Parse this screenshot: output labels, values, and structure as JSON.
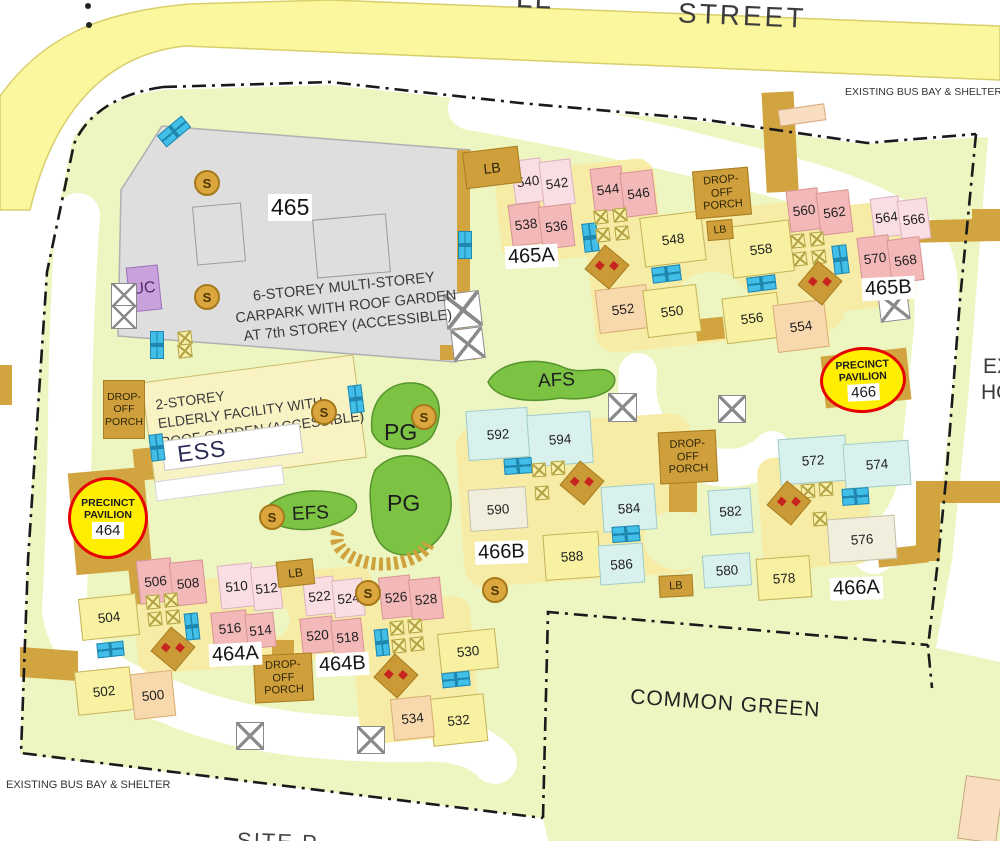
{
  "street": {
    "name": "STREET",
    "fragment": "LL"
  },
  "notes": {
    "bus_bay": "EXISTING BUS BAY & SHELTER",
    "common_green": "COMMON GREEN",
    "site_plan_fragment": "SITE P",
    "existing_right_line1": "EX",
    "existing_right_line2": "HO"
  },
  "carpark": {
    "number": "465",
    "line1": "6-STOREY MULTI-STOREY",
    "line2": "CARPARK WITH ROOF GARDEN",
    "line3": "AT 7th STOREY (ACCESSIBLE)",
    "uc": "UC"
  },
  "facility": {
    "line1": "2-STOREY",
    "line2": "ELDERLY FACILITY WITH",
    "line3": "ROOF GARDEN (ACCESSIBLE)",
    "ess": "ESS"
  },
  "areas": {
    "pg": "PG",
    "afs": "AFS",
    "efs": "EFS"
  },
  "clusters": {
    "c465": "465",
    "c465a": "465A",
    "c465b": "465B",
    "c466a": "466A",
    "c466b": "466B",
    "c464a": "464A",
    "c464b": "464B"
  },
  "pavilions": {
    "p464": {
      "line1": "PRECINCT",
      "line2": "PAVILION",
      "number": "464"
    },
    "p466": {
      "line1": "PRECINCT",
      "line2": "PAVILION",
      "number": "466"
    }
  },
  "porch": {
    "l1": "DROP-OFF",
    "l2": "PORCH",
    "s1": "DROP-",
    "s2": "OFF",
    "s3": "PORCH"
  },
  "lb_label": "LB",
  "s_label": "S",
  "units": {
    "u500": "500",
    "u502": "502",
    "u504": "504",
    "u506": "506",
    "u508": "508",
    "u510": "510",
    "u512": "512",
    "u514": "514",
    "u516": "516",
    "u518": "518",
    "u520": "520",
    "u522": "522",
    "u524": "524",
    "u526": "526",
    "u528": "528",
    "u530": "530",
    "u532": "532",
    "u534": "534",
    "u536": "536",
    "u538": "538",
    "u540": "540",
    "u542": "542",
    "u544": "544",
    "u546": "546",
    "u548": "548",
    "u550": "550",
    "u552": "552",
    "u554": "554",
    "u556": "556",
    "u558": "558",
    "u560": "560",
    "u562": "562",
    "u564": "564",
    "u566": "566",
    "u568": "568",
    "u570": "570",
    "u572": "572",
    "u574": "574",
    "u576": "576",
    "u578": "578",
    "u580": "580",
    "u582": "582",
    "u584": "584",
    "u586": "586",
    "u588": "588",
    "u590": "590",
    "u592": "592",
    "u594": "594"
  },
  "colors": {
    "site_green": "#edf5c1",
    "road_yellow": "#fbf79e",
    "path_tan": "#d2a440",
    "carpark_gray": "#dedede",
    "block_yellow": "#f8f1a2",
    "block_pink": "#f3b9b9",
    "block_light_pink": "#f9dee3",
    "block_peach": "#f8d9ae",
    "block_pale_cyan": "#d9f1ed",
    "block_cream": "#f1eedd",
    "lift_cyan": "#41bfe8",
    "s_gold": "#dca63e",
    "uc_purple": "#c9a2dd",
    "green_area": "#7cc243",
    "pavilion_yellow": "#ffee00",
    "pavilion_ring_red": "#e60000",
    "boundary_black": "#1a1a1a"
  }
}
